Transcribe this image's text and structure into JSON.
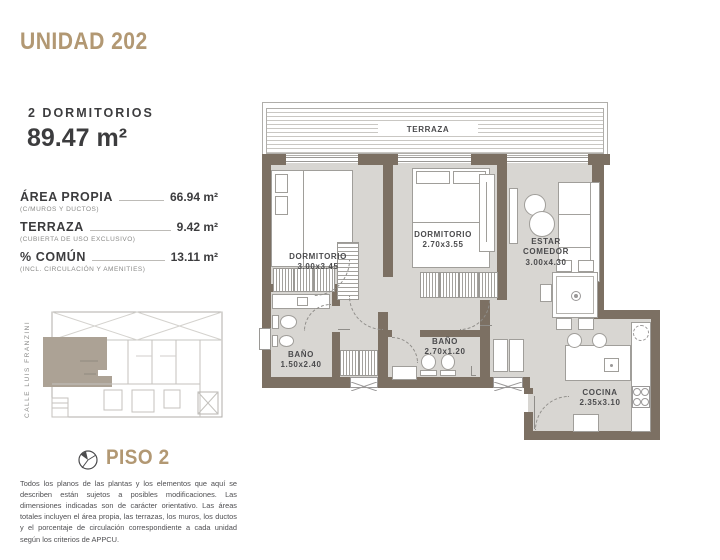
{
  "unit": {
    "title": "UNIDAD 202",
    "type_label": "2 DORMITORIOS",
    "total_area": "89.47 m²"
  },
  "areas": [
    {
      "label": "ÁREA PROPIA",
      "sublabel": "(C/MUROS Y DUCTOS)",
      "value": "66.94 m²"
    },
    {
      "label": "TERRAZA",
      "sublabel": "(CUBIERTA DE USO EXCLUSIVO)",
      "value": "9.42 m²"
    },
    {
      "label": "% COMÚN",
      "sublabel": "(INCL. CIRCULACIÓN Y AMENITIES)",
      "value": "13.11 m²"
    }
  ],
  "plan": {
    "terraza_label": "TERRAZA",
    "rooms": [
      {
        "name": "DORMITORIO",
        "dims": "3.00x3.45"
      },
      {
        "name": "DORMITORIO",
        "dims": "2.70x3.55"
      },
      {
        "name": "ESTAR COMEDOR",
        "dims": "3.00x4.30"
      },
      {
        "name": "BAÑO",
        "dims": "1.50x2.40"
      },
      {
        "name": "BAÑO",
        "dims": "2.70x1.20"
      },
      {
        "name": "COCINA",
        "dims": "2.35x3.10"
      }
    ]
  },
  "site": {
    "street_label": "CALLE LUIS FRANZINI",
    "floor_label": "PISO 2"
  },
  "disclaimer": "Todos los planos de las plantas y los elementos que aquí se describen están sujetos a posibles modificaciones. Las dimensiones indicadas son de carácter orientativo. Las áreas totales incluyen el área propia, las terrazas, los muros, los ductos y el porcentaje de circulación correspondiente a cada unidad según los criterios de APPCU.",
  "colors": {
    "accent_gold": "#b29873",
    "wall": "#7c7063",
    "floor": "#d8d6d2",
    "highlight": "#aca295"
  }
}
